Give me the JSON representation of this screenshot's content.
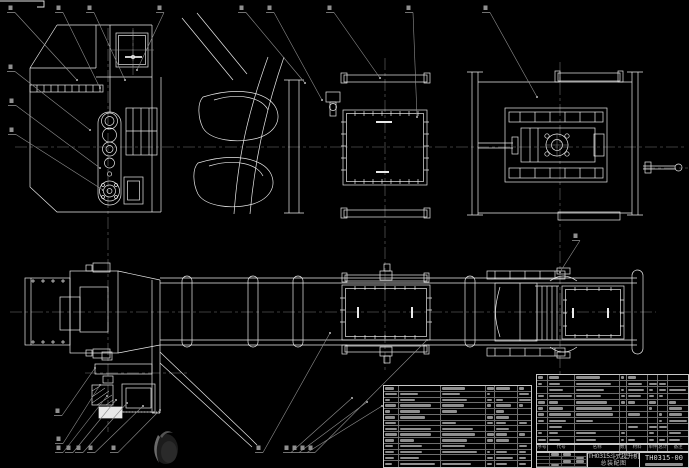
{
  "title_block": {
    "product_title": "TH0315斗式提升机",
    "sheet_title": "总装配图",
    "drawing_number": "TH0315-00"
  },
  "bom": {
    "header_labels": [
      "序号",
      "代号",
      "名称",
      "数量",
      "材料",
      "单件",
      "总计",
      "备注"
    ],
    "left_table": {
      "visible_rows": 14,
      "column_widths": [
        15,
        42,
        46,
        9,
        23,
        13
      ]
    },
    "right_table": {
      "visible_rows": 11,
      "column_widths": [
        11,
        28,
        45,
        7,
        22,
        10,
        10,
        20
      ]
    }
  },
  "callouts": {
    "leaders": [
      [
        10,
        8,
        77,
        80
      ],
      [
        58,
        8,
        100,
        88
      ],
      [
        89,
        8,
        125,
        80
      ],
      [
        159,
        8,
        137,
        70
      ],
      [
        241,
        8,
        305,
        83
      ],
      [
        269,
        8,
        322,
        100
      ],
      [
        329,
        8,
        380,
        78
      ],
      [
        408,
        8,
        417,
        117
      ],
      [
        485,
        8,
        537,
        97
      ],
      [
        10,
        67,
        90,
        130
      ],
      [
        11,
        101,
        100,
        168
      ],
      [
        11,
        130,
        103,
        190
      ],
      [
        57,
        411,
        95,
        368
      ],
      [
        58,
        439,
        100,
        385
      ],
      [
        58,
        448,
        107,
        396
      ],
      [
        68,
        448,
        116,
        400
      ],
      [
        78,
        448,
        127,
        403
      ],
      [
        90,
        448,
        143,
        406
      ],
      [
        113,
        448,
        160,
        410
      ],
      [
        258,
        448,
        330,
        333
      ],
      [
        286,
        448,
        352,
        398
      ],
      [
        294,
        448,
        367,
        402
      ],
      [
        302,
        448,
        382,
        406
      ],
      [
        310,
        448,
        427,
        340
      ],
      [
        575,
        236,
        560,
        272
      ]
    ]
  },
  "colors": {
    "background": "#000000",
    "geometry": "#e9e9e9",
    "annotation": "#8f8f8f",
    "table_line": "#c9c9c9",
    "table_text": "#8f8f8f"
  }
}
